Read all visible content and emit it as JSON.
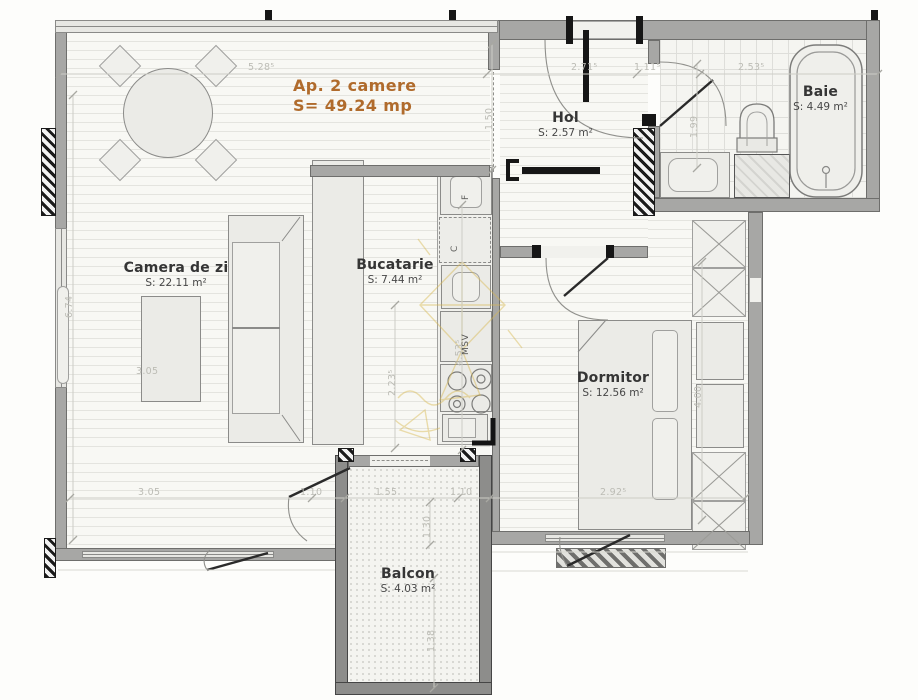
{
  "title": {
    "name": "Ap. 2 camere",
    "area": "S= 49.24 mp"
  },
  "rooms": {
    "living": {
      "name": "Camera de zi",
      "area": "S: 22.11 m²"
    },
    "kitchen": {
      "name": "Bucatarie",
      "area": "S: 7.44 m²"
    },
    "hall": {
      "name": "Hol",
      "area": "S: 2.57 m²"
    },
    "bath": {
      "name": "Baie",
      "area": "S: 4.49 m²"
    },
    "bedroom": {
      "name": "Dormitor",
      "area": "S: 12.56 m²"
    },
    "balcony": {
      "name": "Balcon",
      "area": "S: 4.03 m²"
    }
  },
  "appliances": {
    "fridge": "F",
    "oven": "C",
    "dishwasher": "MSV"
  },
  "dimensions": {
    "top_living": "5.28⁵",
    "top_hall": "2.71⁵",
    "top_entry": "1.11⁵",
    "top_bath": "2.53⁵",
    "hall_depth": "1.50",
    "bath_depth": "1.99",
    "left_height": "6.74",
    "living_width_mid": "3.05",
    "living_width": "3.05",
    "balcony_left_gap": "1.10",
    "balcony_width": "1.55",
    "balcony_right_gap": "1.10",
    "bedroom_width": "2.92⁵",
    "balcony_door": "1.30",
    "balcony_depth": "1.38",
    "kitchen_width": "2.23⁵",
    "kitchen_length": "4.53⁵",
    "bedroom_height": "4.00"
  },
  "colors": {
    "accent": "#b06b2c",
    "wall": "#a7a7a5",
    "wall_dark": "#8d8d8b",
    "dim_text": "#bcbcb5",
    "room_text": "#353535",
    "watermark": "#d8b850"
  }
}
